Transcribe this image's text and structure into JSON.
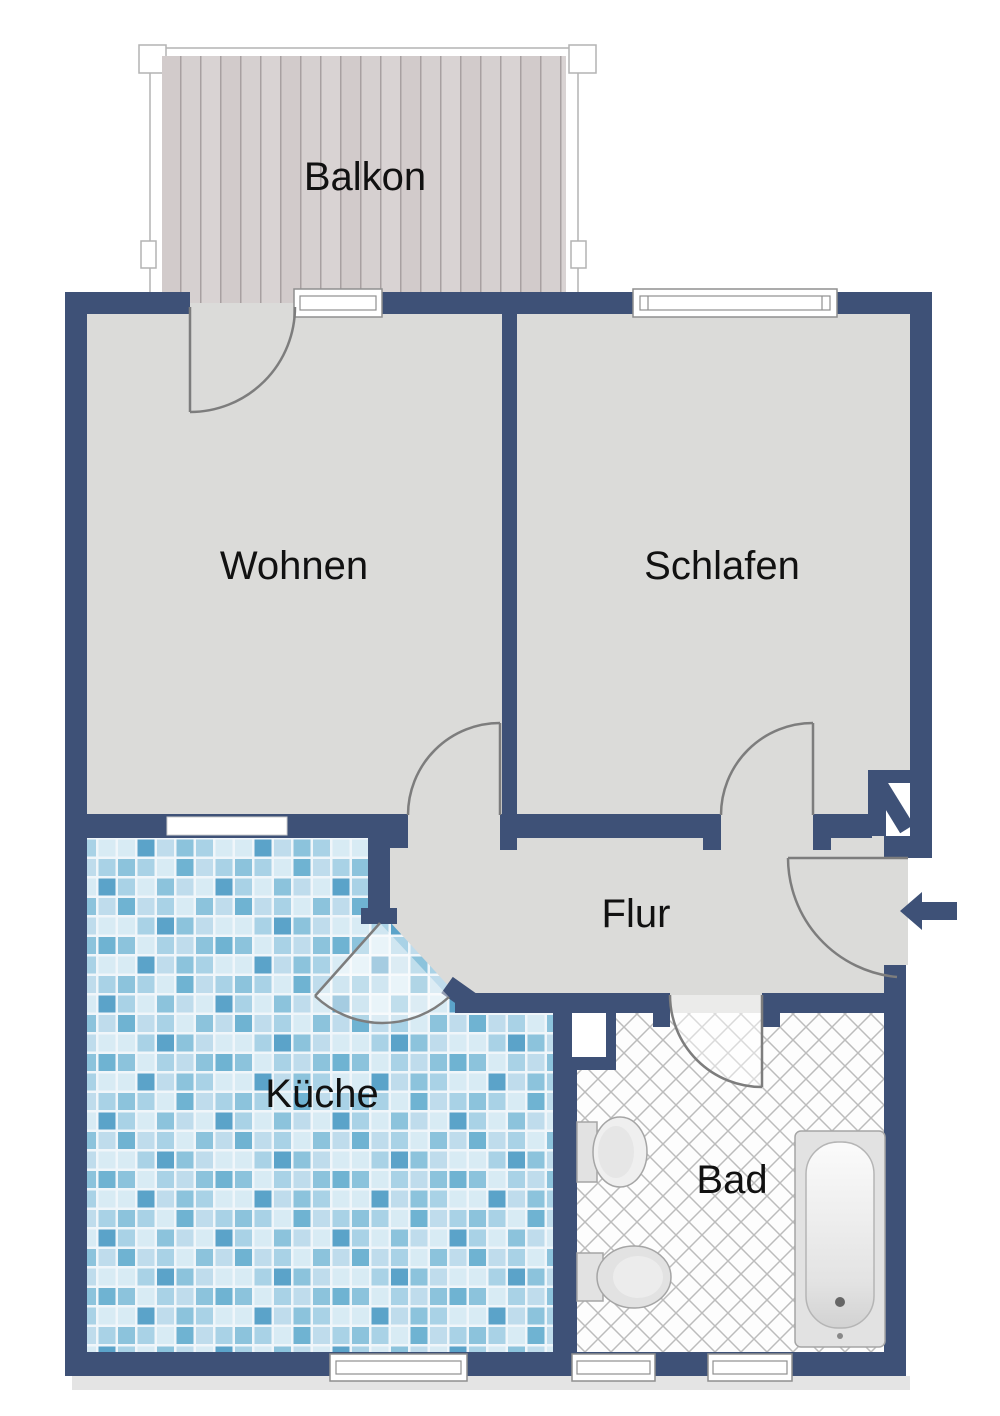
{
  "document": {
    "type": "apartment-floor-plan"
  },
  "colors": {
    "wall": "#3e5177",
    "floor": "#dbdbd9",
    "doorline": "#7d7d7d",
    "winframe": "#8f8f8f",
    "labelcolor": "#111111",
    "wood": "#d6d0d0",
    "woodline": "#a8a0a1",
    "grout": "#f0f6fa",
    "hatch": "#bcbcbc",
    "shadow": "#e4e4e4",
    "tile1": "#bfdcec",
    "tile2": "#8cc3dc",
    "tile3": "#a9d2e6",
    "tile4": "#d8ebf4",
    "tile5": "#6fb3d2",
    "tile6": "#5ba3c9",
    "fixture_fill": "#efefef",
    "fixture_stroke": "#a5a5a5"
  },
  "rooms": {
    "balcony": {
      "label": "Balkon"
    },
    "living": {
      "label": "Wohnen"
    },
    "bedroom": {
      "label": "Schlafen"
    },
    "hallway": {
      "label": "Flur"
    },
    "kitchen": {
      "label": "Küche"
    },
    "bathroom": {
      "label": "Bad"
    }
  },
  "icons": {
    "entrance_arrow": "arrow-left-entrance"
  }
}
